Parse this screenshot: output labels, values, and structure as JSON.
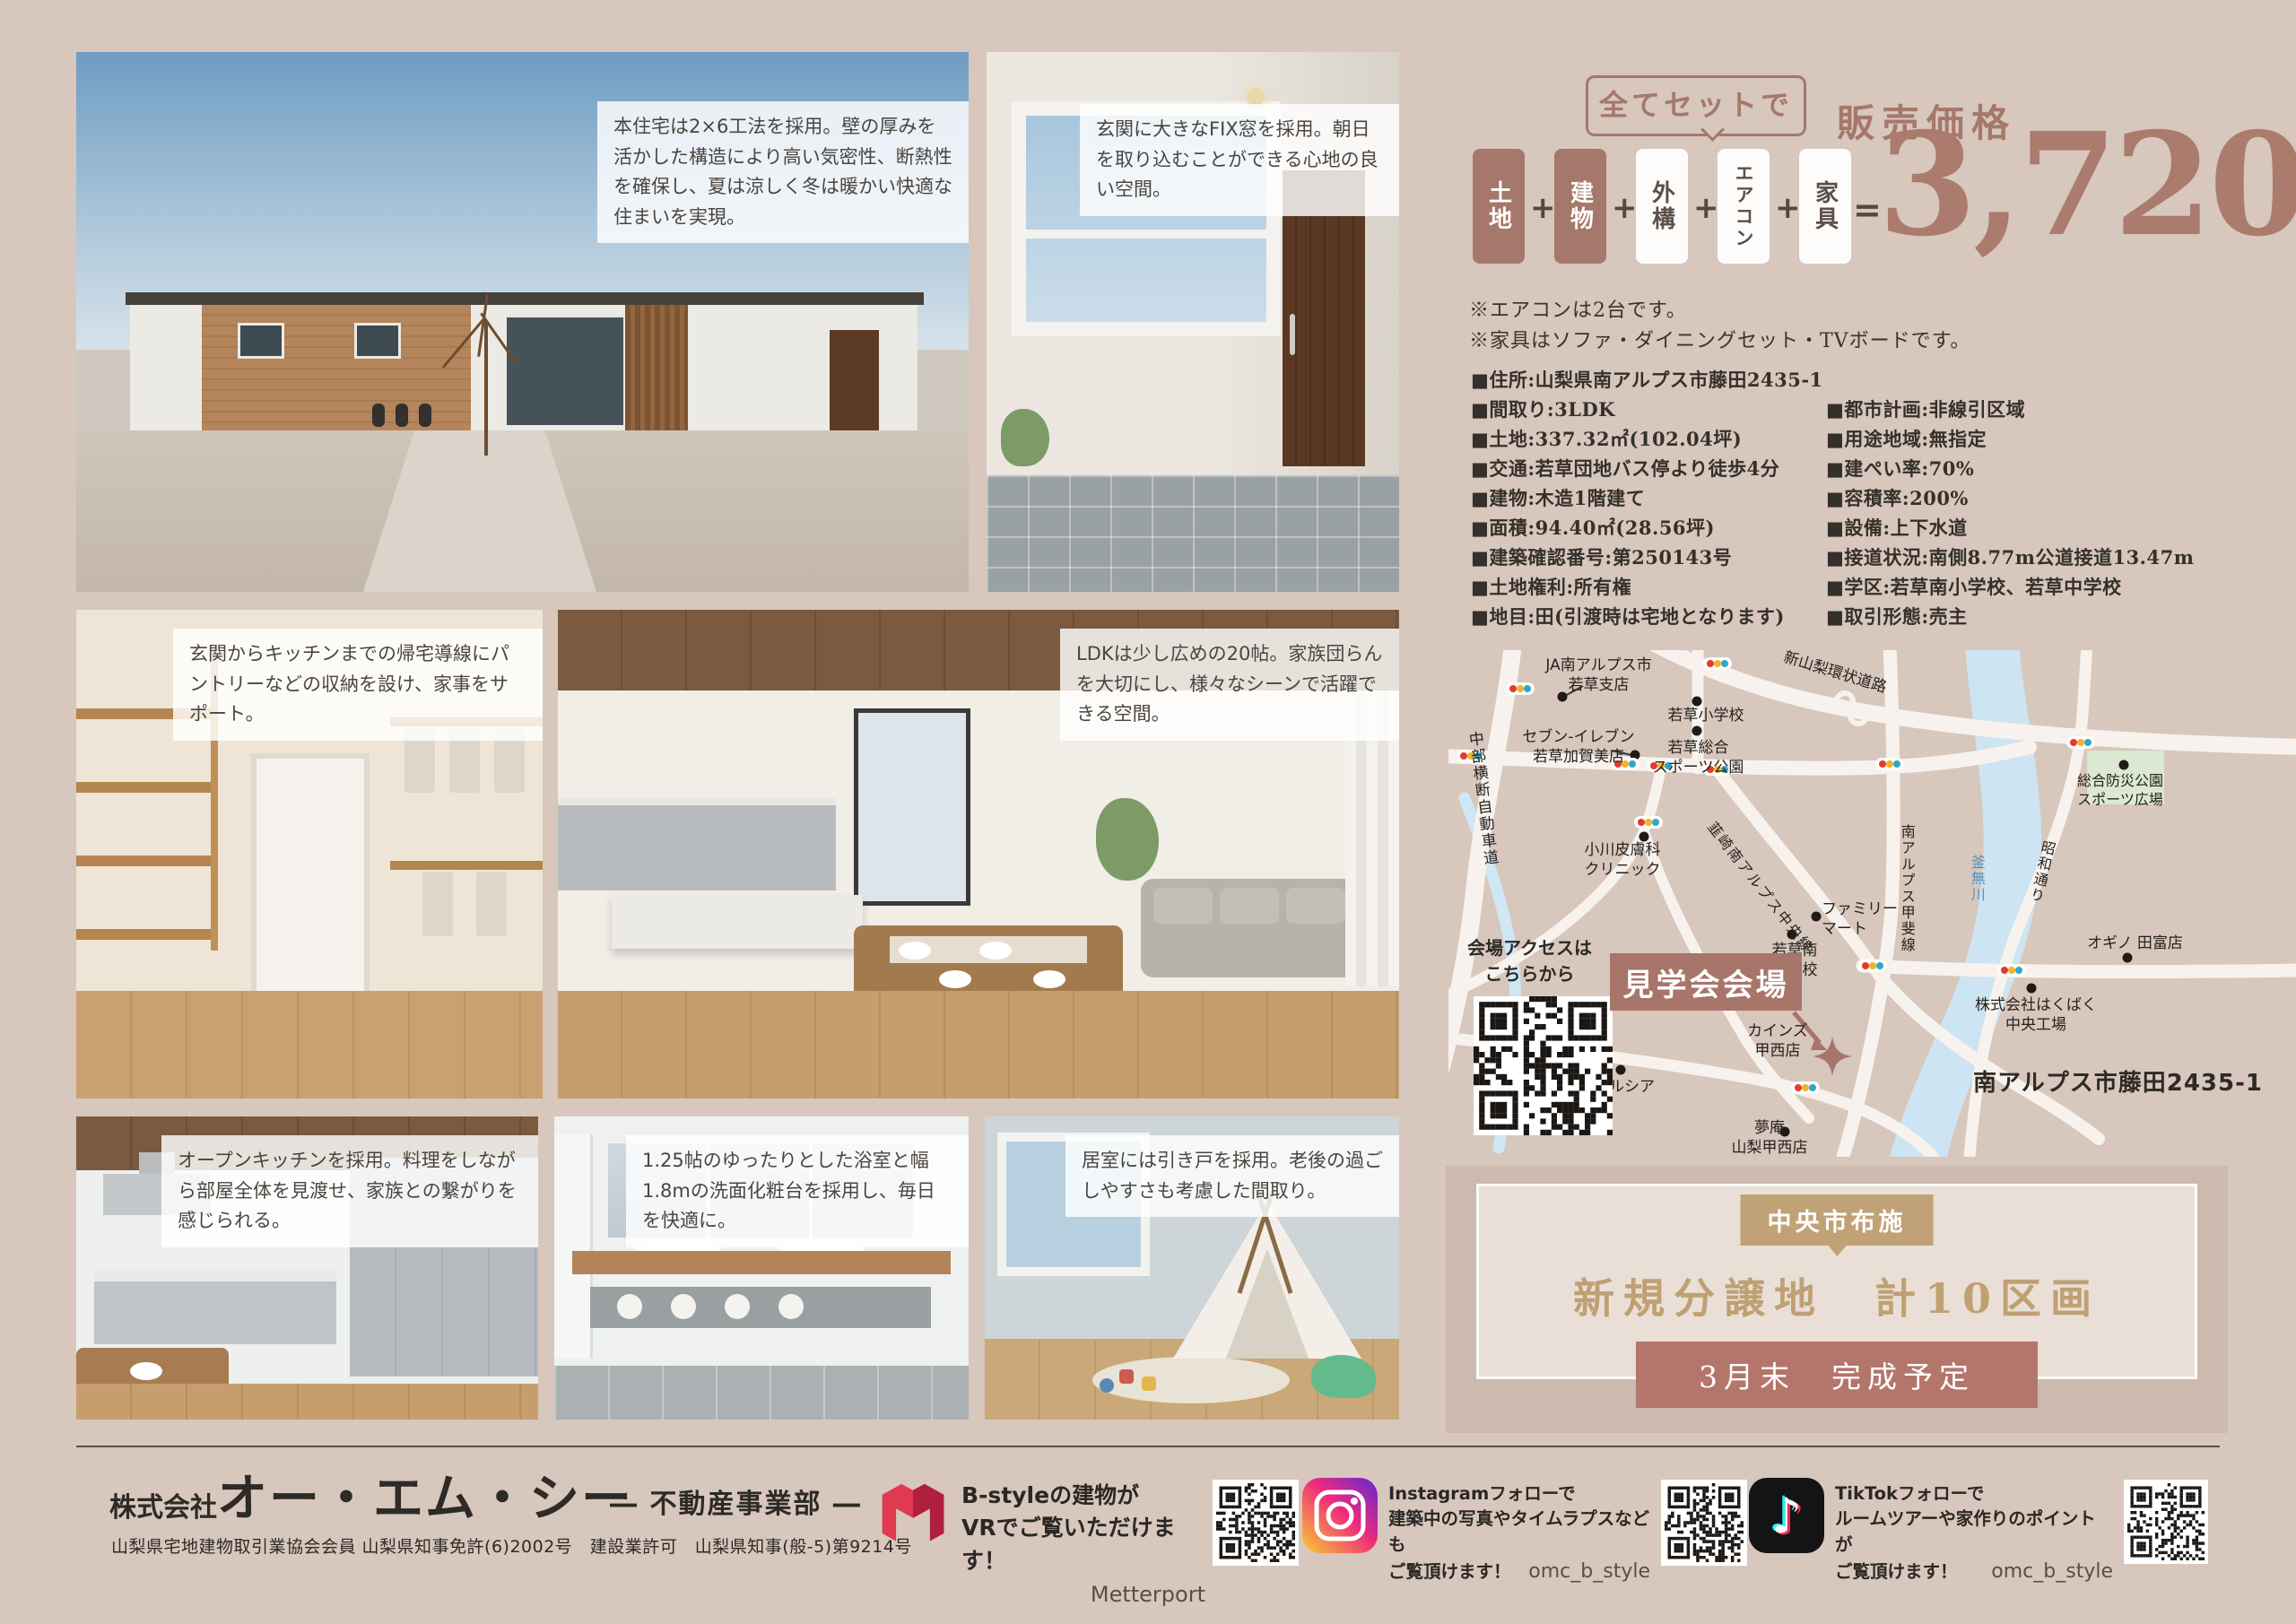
{
  "photos": {
    "exterior": {
      "caption": "本住宅は2×6工法を採用。壁の厚みを活かした構造により高い気密性、断熱性を確保し、夏は涼しく冬は暖かい快適な住まいを実現。"
    },
    "entrance": {
      "caption": "玄関に大きなFIX窓を採用。朝日を取り込むことができる心地の良い空間。"
    },
    "pantry": {
      "caption": "玄関からキッチンまでの帰宅導線にパントリーなどの収納を設け、家事をサポート。"
    },
    "ldk": {
      "caption": "LDKは少し広めの20帖。家族団らんを大切にし、様々なシーンで活躍できる空間。"
    },
    "kitchen": {
      "caption": "オープンキッチンを採用。料理をしながら部屋全体を見渡せ、家族との繋がりを感じられる。"
    },
    "bathroom": {
      "caption": "1.25帖のゆったりとした浴室と幅1.8mの洗面化粧台を採用し、毎日を快適に。"
    },
    "bedroom": {
      "caption": "居室には引き戸を採用。老後の過ごしやすさも考慮した間取り。"
    }
  },
  "price": {
    "bubble": "全てセットで",
    "label": "販売価格",
    "components": [
      "土地",
      "建物",
      "外構",
      "エアコン",
      "家具"
    ],
    "plus": "+",
    "equals": "=",
    "amount": "3,720",
    "unit": "万円",
    "notes": [
      "※エアコンは2台です。",
      "※家具はソファ・ダイニングセット・TVボードです。"
    ]
  },
  "details": {
    "left": [
      "■住所:山梨県南アルプス市藤田2435-1",
      "■間取り:3LDK",
      "■土地:337.32㎡(102.04坪)",
      "■交通:若草団地バス停より徒歩4分",
      "■建物:木造1階建て",
      "■面積:94.40㎡(28.56坪)",
      "■建築確認番号:第250143号",
      "■土地権利:所有権",
      "■地目:田(引渡時は宅地となります)"
    ],
    "right": [
      "■都市計画:非線引区域",
      "■用途地域:無指定",
      "■建ぺい率:70%",
      "■容積率:200%",
      "■設備:上下水道",
      "■接道状況:南側8.77m公道接道13.47m",
      "■学区:若草南小学校、若草中学校",
      "■取引形態:売主"
    ]
  },
  "map": {
    "access_note": "会場アクセスは\nこちらから",
    "venue": "見学会会場",
    "address": "南アルプス市藤田2435-1",
    "labels": {
      "ja": "JA南アルプス市\n若草支店",
      "expressway": "中部横断自動車道",
      "seven": "セブン-イレブン\n若草加賀美店",
      "wakakusa_es": "若草小学校",
      "sports_park": "若草総合\nスポーツ公園",
      "ring_road": "新山梨環状道路",
      "ogawa_clinic": "小川皮膚科\nクリニック",
      "chuo_line": "韮崎南アルプス中央線",
      "familymart": "ファミリー\nマート",
      "wakakusa_minami_es": "若草南\n小学校",
      "kai_line": "南アルプス甲斐線",
      "showa_dori": "昭和通り",
      "kamanashi_river": "釜無川",
      "bousai_park": "総合防災公園\nスポーツ広場",
      "ogino": "オギノ 田富店",
      "hakubaku": "株式会社はくばく\n中央工場",
      "welcia": "ウエルシア",
      "cainz": "カインズ\n甲西店",
      "yumean": "夢庵\n山梨甲西店"
    }
  },
  "promo": {
    "tag": "中央市布施",
    "headline": "新規分譲地　計10区画",
    "completion": "3月末　完成予定"
  },
  "footer": {
    "company_prefix": "株式会社",
    "company_name": "オー・エム・シー",
    "division": "― 不動産事業部 ―",
    "license": "山梨県宅地建物取引業協会会員 山梨県知事免許(6)2002号　建設業許可　山梨県知事(般-5)第9214号",
    "social": {
      "bstyle": {
        "line1": "B-styleの建物が",
        "line2": "VRでご覧いただけます！",
        "credit": "Metterport"
      },
      "instagram": {
        "line1": "Instagramフォローで",
        "line2": "建築中の写真やタイムラプスなども",
        "line3": "ご覧頂けます！",
        "handle": "omc_b_style"
      },
      "tiktok": {
        "line1": "TikTokフォローで",
        "line2": "ルームツアーや家作りのポイントが",
        "line3": "ご覧頂けます！",
        "handle": "omc_b_style"
      }
    }
  },
  "colors": {
    "accent_brown": "#a5786b",
    "accent_tan": "#c1a276",
    "rose_box": "#b4766b",
    "background": "#d7c7bc"
  }
}
